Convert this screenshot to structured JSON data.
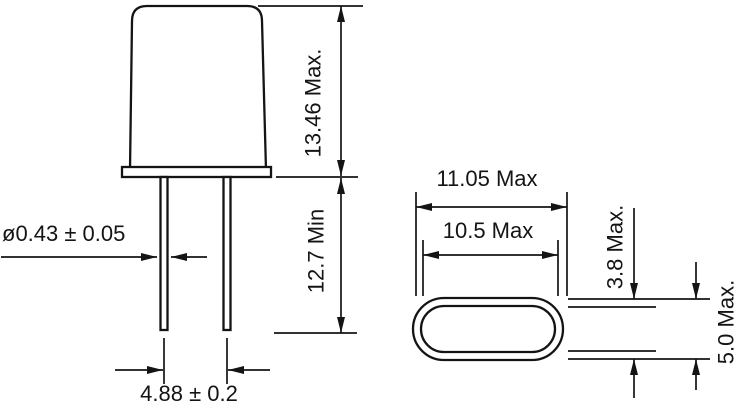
{
  "figure": {
    "side_view": {
      "can_height": "13.46 Max.",
      "lead_length": "12.7 Min",
      "lead_diameter": "ø0.43 ± 0.05",
      "lead_spacing": "4.88 ± 0.2"
    },
    "top_view": {
      "outer_length": "11.05 Max",
      "inner_length": "10.5 Max",
      "inner_width": "3.8 Max.",
      "outer_width": "5.0 Max."
    },
    "colors": {
      "line": "#141414",
      "background": "#ffffff"
    }
  }
}
